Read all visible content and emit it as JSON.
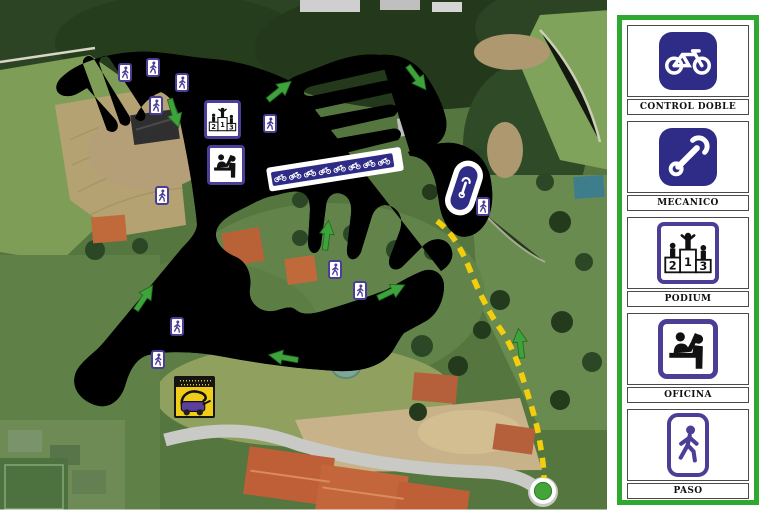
{
  "title": "cyclocross-course-map",
  "podium_numbers": [
    "2",
    "1",
    "3"
  ],
  "legend": {
    "frame_color": "#2FA82F",
    "items": [
      {
        "label": "CONTROL DOBLE",
        "icon": "bicycle-icon",
        "tile": "navy-filled"
      },
      {
        "label": "MECANICO",
        "icon": "wrench-icon",
        "tile": "navy-filled"
      },
      {
        "label": "PODIUM",
        "icon": "podium-icon",
        "tile": "white-outlined"
      },
      {
        "label": "OFICINA",
        "icon": "office-desk-icon",
        "tile": "white-outlined"
      },
      {
        "label": "PASO",
        "icon": "pedestrian-icon",
        "tile": "white-outlined"
      }
    ]
  },
  "map": {
    "course_color": "#FFDF35",
    "course_dashed_color": "#F2CE0C",
    "direction_arrow_color": "#3FA33C",
    "marker_navy": "#2E2C86",
    "marker_purple": "#4C3D97",
    "start_dot_color": "#44A437",
    "marker_icons": {
      "pedestrian_crossing": "pedestrian-icon",
      "podium": "podium-icon",
      "office": "office-desk-icon",
      "mechanic_pit": "wrench-icon",
      "start_grid": "bicycle-row-icon",
      "mower": "mower-icon",
      "start_point": "start-dot-icon",
      "hazard_zone": "hazard-stripes"
    }
  }
}
